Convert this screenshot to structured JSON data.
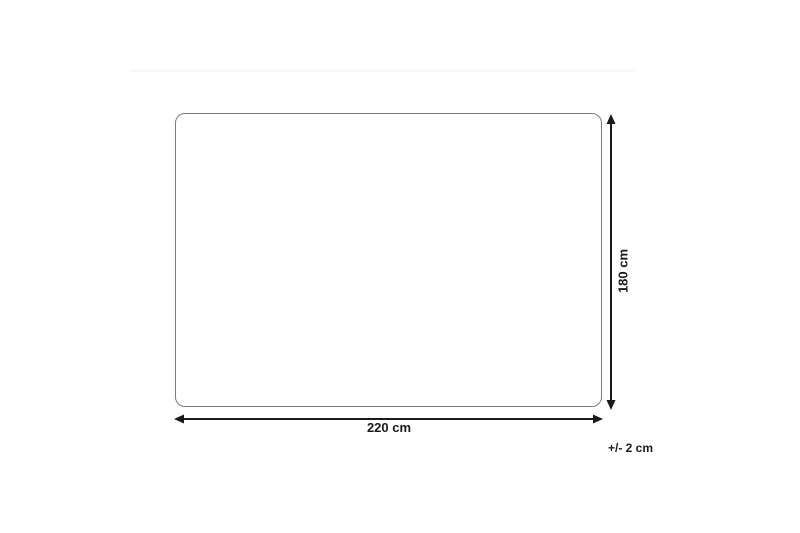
{
  "diagram": {
    "type": "product-dimension-diagram",
    "shape": "rounded-rectangle",
    "width_label": "220 cm",
    "height_label": "180 cm",
    "tolerance_label": "+/- 2 cm"
  },
  "theme": {
    "bg": "#ffffff",
    "outline": "#7b7b7b",
    "arrow": "#1a1a1a",
    "label": "#1a1a1a",
    "artifact": "#f8f8f8"
  }
}
